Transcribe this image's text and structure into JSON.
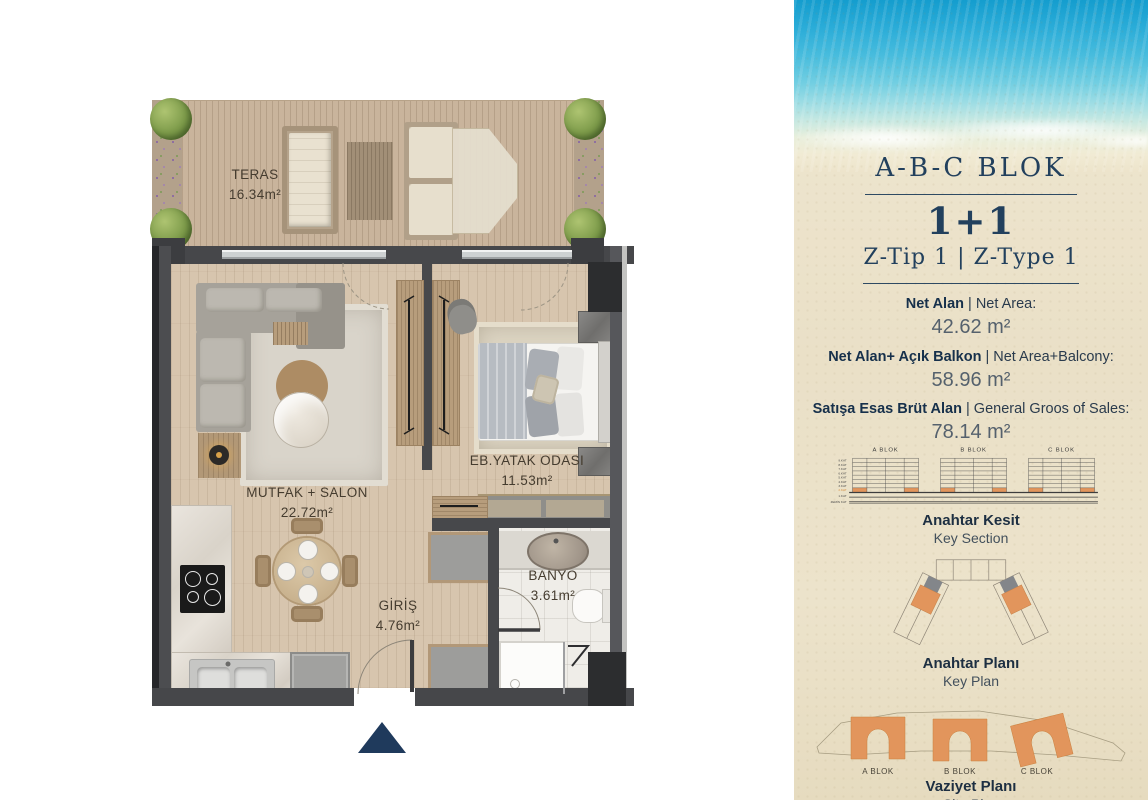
{
  "floor_plan": {
    "rooms": [
      {
        "name": "TERAS",
        "area": "16.34m²"
      },
      {
        "name": "MUTFAK + SALON",
        "area": "22.72m²"
      },
      {
        "name": "EB.YATAK ODASI",
        "area": "11.53m²"
      },
      {
        "name": "BANYO",
        "area": "3.61m²"
      },
      {
        "name": "GİRİŞ",
        "area": "4.76m²"
      }
    ]
  },
  "info_panel": {
    "block_title": "A-B-C BLOK",
    "unit_type": "1+1",
    "type_label": "Z-Tip 1 | Z-Type 1",
    "areas": [
      {
        "label_tr": "Net Alan",
        "label_en": "| Net Area:",
        "value": "42.62 m²"
      },
      {
        "label_tr": "Net Alan+ Açık Balkon",
        "label_en": "| Net Area+Balcony:",
        "value": "58.96 m²"
      },
      {
        "label_tr": "Satışa Esas Brüt Alan",
        "label_en": "| General Groos of Sales:",
        "value": "78.14 m²"
      }
    ],
    "key_section": {
      "blocks": [
        "A BLOK",
        "B BLOK",
        "C BLOK"
      ],
      "floors": [
        "9.KAT",
        "8.KAT",
        "7.KAT",
        "6.KAT",
        "5.KAT",
        "4.KAT",
        "3.KAT",
        "2.KAT",
        "1.KAT",
        "ZEMİN KAT"
      ],
      "highlighted_floor": "2.KAT",
      "title_tr": "Anahtar Kesit",
      "title_en": "Key Section"
    },
    "key_plan": {
      "title_tr": "Anahtar Planı",
      "title_en": "Key Plan"
    },
    "site_plan": {
      "blocks": [
        "A BLOK",
        "B BLOK",
        "C BLOK"
      ],
      "title_tr": "Vaziyet Planı",
      "title_en": "Site Plan"
    },
    "colors": {
      "navy": "#22405d",
      "orange": "#e2955c",
      "sand": "#ece3cb"
    }
  }
}
